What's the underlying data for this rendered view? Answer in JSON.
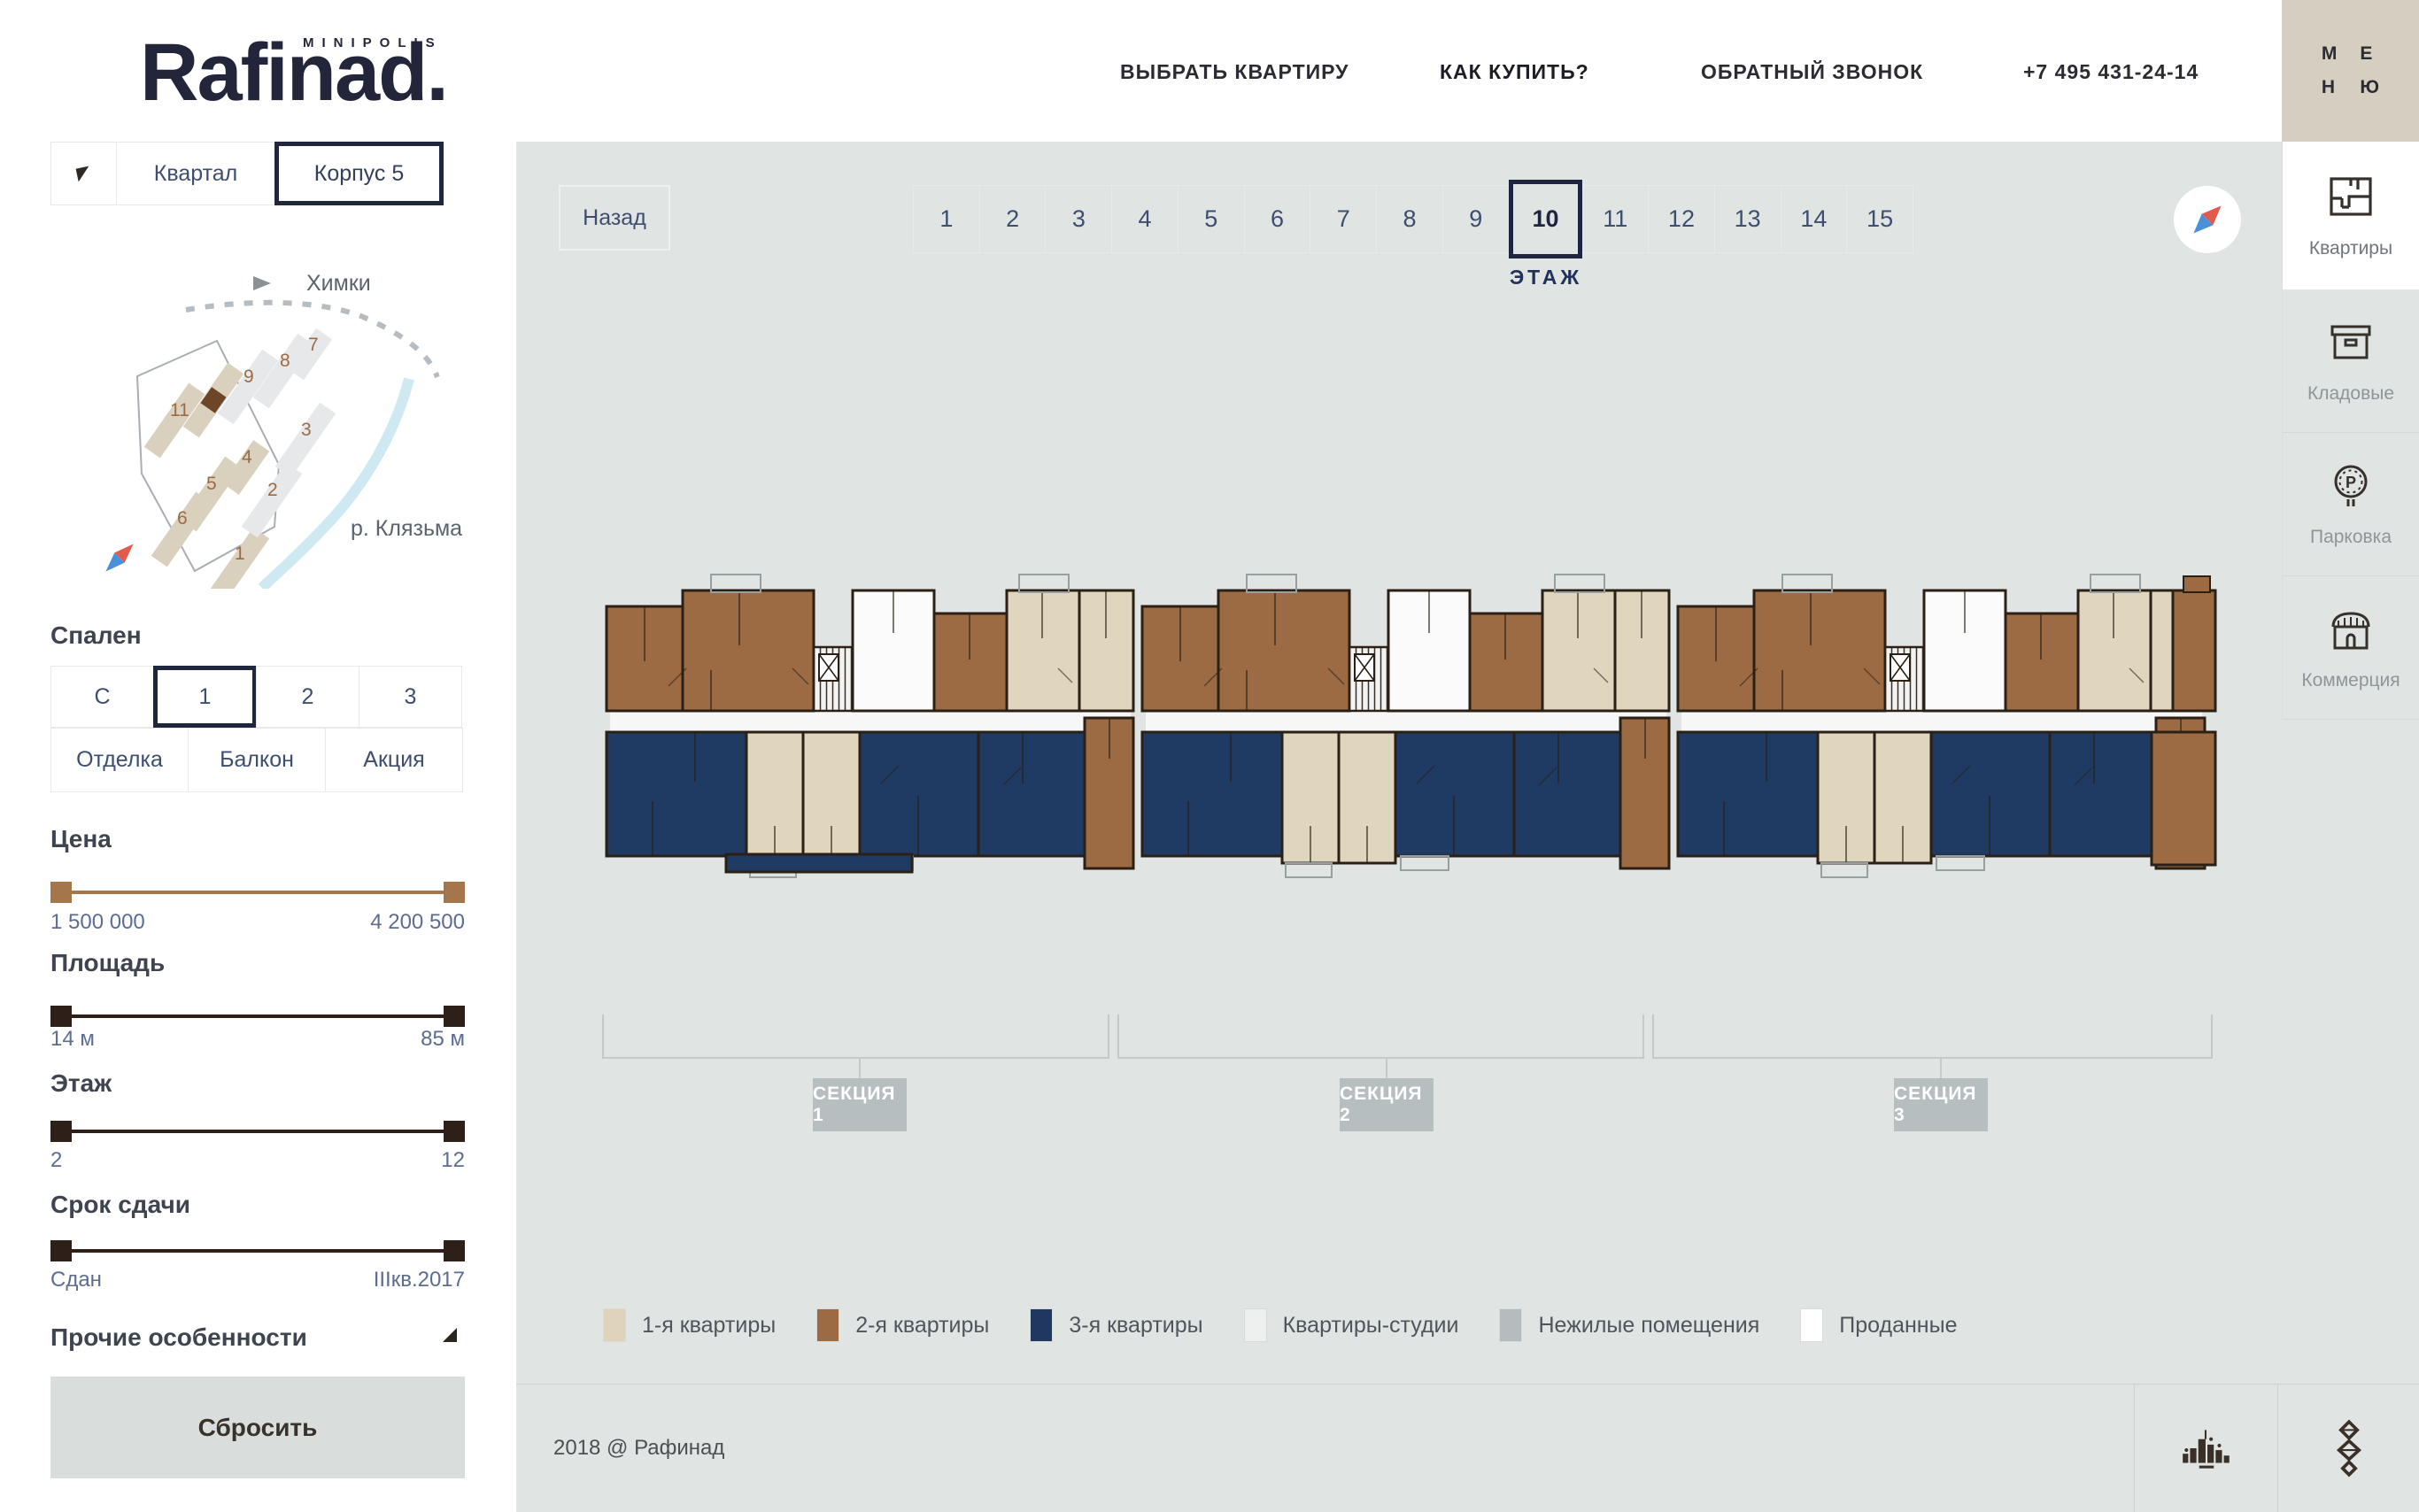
{
  "brand": {
    "logo": "Rafinad.",
    "minipolis": "MINIPOLIS"
  },
  "header": {
    "nav": [
      {
        "label": "ВЫБРАТЬ КВАРТИРУ"
      },
      {
        "label": "КАК КУПИТЬ?"
      },
      {
        "label": "ОБРАТНЫЙ ЗВОНОК"
      },
      {
        "label": "+7 495 431-24-14"
      }
    ]
  },
  "menu_button": {
    "letters": [
      "М",
      "Е",
      "Н",
      "Ю"
    ]
  },
  "rail": {
    "items": [
      {
        "label": "Квартиры",
        "icon": "floorplan-icon",
        "active": true
      },
      {
        "label": "Кладовые",
        "icon": "storage-box-icon",
        "active": false
      },
      {
        "label": "Парковка",
        "icon": "parking-sign-icon",
        "icon_letter": "P",
        "active": false
      },
      {
        "label": "Коммерция",
        "icon": "shop-icon",
        "active": false
      }
    ]
  },
  "sidebar": {
    "tabs": {
      "flag_icon": "flag-icon",
      "items": [
        {
          "label": "Квартал",
          "active": false
        },
        {
          "label": "Корпус 5",
          "active": true
        }
      ]
    },
    "map": {
      "city": "Химки",
      "river": "р. Клязьма",
      "selected_building_color": "#6d4527",
      "buildings": [
        {
          "label": "11"
        },
        {
          "label": "9"
        },
        {
          "label": "8"
        },
        {
          "label": "7"
        },
        {
          "label": "3"
        },
        {
          "label": "4"
        },
        {
          "label": "5"
        },
        {
          "label": "2"
        },
        {
          "label": "6"
        },
        {
          "label": "1"
        }
      ]
    },
    "bedrooms": {
      "title": "Спален",
      "options": [
        {
          "label": "С",
          "active": false
        },
        {
          "label": "1",
          "active": true
        },
        {
          "label": "2",
          "active": false
        },
        {
          "label": "3",
          "active": false
        }
      ]
    },
    "features": [
      {
        "label": "Отделка"
      },
      {
        "label": "Балкон"
      },
      {
        "label": "Акция"
      }
    ],
    "sliders": [
      {
        "title": "Цена",
        "min": "1 500 000",
        "max": "4 200 500",
        "color": "#a5764a"
      },
      {
        "title": "Площадь",
        "min": "14 м",
        "max": "85 м",
        "color": "#2e2018"
      },
      {
        "title": "Этаж",
        "min": "2",
        "max": "12",
        "color": "#2e2018"
      },
      {
        "title": "Срок сдачи",
        "min": "Сдан",
        "max": "IIIкв.2017",
        "color": "#2e2018"
      }
    ],
    "more": {
      "label": "Прочие особенности"
    },
    "reset": {
      "label": "Сбросить"
    }
  },
  "main": {
    "back": {
      "label": "Назад"
    },
    "floors": {
      "items": [
        "1",
        "2",
        "3",
        "4",
        "5",
        "6",
        "7",
        "8",
        "9",
        "10",
        "11",
        "12",
        "13",
        "14",
        "15"
      ],
      "selected": "10",
      "caption": "ЭТАЖ"
    },
    "compass_icon": "compass-icon",
    "sections": [
      {
        "label": "СЕКЦИЯ 1"
      },
      {
        "label": "СЕКЦИЯ 2"
      },
      {
        "label": "СЕКЦИЯ 3"
      }
    ],
    "legend": {
      "items": [
        {
          "label": "1-я квартиры",
          "color": "#dfd3bb"
        },
        {
          "label": "2-я квартиры",
          "color": "#9c6b44"
        },
        {
          "label": "3-я квартиры",
          "color": "#20375f"
        },
        {
          "label": "Квартиры-студии",
          "color": "#eef0ef"
        },
        {
          "label": "Нежилые помещения",
          "color": "#b5bcbe"
        },
        {
          "label": "Проданные",
          "color": "#ffffff"
        }
      ]
    },
    "footer": {
      "copyright": "2018 @ Рафинад",
      "logo_icons": [
        "city-logo-icon",
        "ornament-logo-icon"
      ]
    }
  }
}
